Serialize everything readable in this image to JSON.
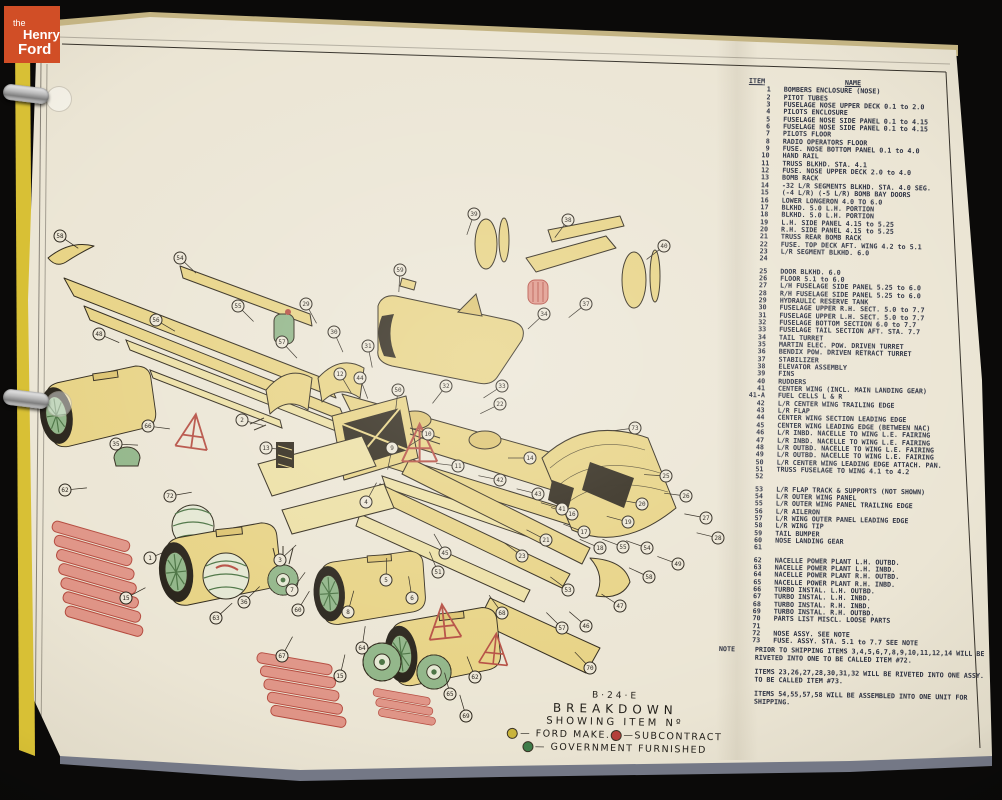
{
  "colors": {
    "page": "#ebe5d4",
    "part_yellow": "#e7d282",
    "part_shade": "#dcc26c",
    "outline": "#2b2416",
    "green": "#8fb486",
    "green_dark": "#47703f",
    "red": "#b44a3e",
    "red_light": "#df9486",
    "ink": "#2c3142",
    "logo_orange": "#d14e26",
    "binder_yellow": "#d8c035"
  },
  "logo": {
    "line1": "the",
    "line2": "Henry",
    "line3": "Ford"
  },
  "parts_list": {
    "header_item": "ITEM",
    "header_name": "NAME",
    "items": [
      {
        "no": "1",
        "name": "BOMBERS ENCLOSURE (NOSE)"
      },
      {
        "no": "2",
        "name": "PITOT TUBES"
      },
      {
        "no": "3",
        "name": "FUSELAGE NOSE UPPER DECK 0.1 to 2.0"
      },
      {
        "no": "4",
        "name": "PILOTS ENCLOSURE"
      },
      {
        "no": "5",
        "name": "FUSELAGE NOSE SIDE PANEL 0.1 to 4.15"
      },
      {
        "no": "6",
        "name": "FUSELAGE NOSE SIDE PANEL 0.1 to 4.15"
      },
      {
        "no": "7",
        "name": "PILOTS FLOOR"
      },
      {
        "no": "8",
        "name": "RADIO OPERATORS FLOOR"
      },
      {
        "no": "9",
        "name": "FUSE. NOSE BOTTOM PANEL 0.1 to 4.0"
      },
      {
        "no": "10",
        "name": "HAND RAIL"
      },
      {
        "no": "11",
        "name": "TRUSS BLKHD. STA. 4.1"
      },
      {
        "no": "12",
        "name": "FUSE. NOSE UPPER DECK 2.0 to 4.0"
      },
      {
        "no": "13",
        "name": "BOMB RACK"
      },
      {
        "no": "14",
        "name": "-32 L/R SEGMENTS BLKHD. STA. 4.0 SEG."
      },
      {
        "no": "15",
        "name": "(-4 L/R) (-5 L/R) BOMB BAY DOORS"
      },
      {
        "no": "16",
        "name": "LOWER LONGERON 4.0 TO 6.0"
      },
      {
        "no": "17",
        "name": "BLKHD. 5.0 L.H. PORTION"
      },
      {
        "no": "18",
        "name": "BLKHD. 5.0 L.H. PORTION"
      },
      {
        "no": "19",
        "name": "L.H. SIDE PANEL 4.15 to 5.25"
      },
      {
        "no": "20",
        "name": "R.H. SIDE PANEL 4.15 to 5.25"
      },
      {
        "no": "21",
        "name": "TRUSS REAR BOMB RACK"
      },
      {
        "no": "22",
        "name": "FUSE. TOP DECK AFT. WING 4.2 to 5.1"
      },
      {
        "no": "23",
        "name": "L/R SEGMENT BLKHD. 6.0"
      },
      {
        "no": "24",
        "name": "",
        "gap": true
      },
      {
        "no": "25",
        "name": "DOOR BLKHD. 6.0"
      },
      {
        "no": "26",
        "name": "FLOOR 5.1 to 6.0"
      },
      {
        "no": "27",
        "name": "L/H FUSELAGE SIDE PANEL 5.25 to 6.0"
      },
      {
        "no": "28",
        "name": "R/H FUSELAGE SIDE PANEL 5.25 to 6.0"
      },
      {
        "no": "29",
        "name": "HYDRAULIC RESERVE TANK"
      },
      {
        "no": "30",
        "name": "FUSELAGE UPPER R.H. SECT. 5.0 to 7.7"
      },
      {
        "no": "31",
        "name": "FUSELAGE UPPER L.H. SECT. 5.0 to 7.7"
      },
      {
        "no": "32",
        "name": "FUSELAGE BOTTOM SECTION 6.0 to 7.7"
      },
      {
        "no": "33",
        "name": "FUSELAGE TAIL SECTION AFT. STA. 7.7"
      },
      {
        "no": "34",
        "name": "TAIL TURRET"
      },
      {
        "no": "35",
        "name": "MARTIN ELEC. POW. DRIVEN TURRET"
      },
      {
        "no": "36",
        "name": "BENDIX POW. DRIVEN RETRACT TURRET"
      },
      {
        "no": "37",
        "name": "STABILIZER"
      },
      {
        "no": "38",
        "name": "ELEVATOR ASSEMBLY"
      },
      {
        "no": "39",
        "name": "FINS"
      },
      {
        "no": "40",
        "name": "RUDDERS"
      },
      {
        "no": "41",
        "name": "CENTER WING (INCL. MAIN LANDING GEAR)"
      },
      {
        "no": "41-A",
        "name": "FUEL CELLS L & R"
      },
      {
        "no": "42",
        "name": "L/R CENTER WING TRAILING EDGE"
      },
      {
        "no": "43",
        "name": "L/R FLAP"
      },
      {
        "no": "44",
        "name": "CENTER WING SECTION LEADING EDGE"
      },
      {
        "no": "45",
        "name": "CENTER WING LEADING EDGE (BETWEEN NAC)"
      },
      {
        "no": "46",
        "name": "L/R INBD. NACELLE TO WING L.E. FAIRING"
      },
      {
        "no": "47",
        "name": "L/R INBD. NACELLE TO WING L.E. FAIRING"
      },
      {
        "no": "48",
        "name": "L/R OUTBD. NACELLE TO WING L.E. FAIRING"
      },
      {
        "no": "49",
        "name": "L/R OUTBD. NACELLE TO WING L.E. FAIRING"
      },
      {
        "no": "50",
        "name": "L/R CENTER WING LEADING EDGE ATTACH. PAN."
      },
      {
        "no": "51",
        "name": "TRUSS FUSELAGE TO WING 4.1 to 4.2"
      },
      {
        "no": "52",
        "name": "",
        "gap": true
      },
      {
        "no": "53",
        "name": "L/R FLAP TRACK & SUPPORTS (NOT SHOWN)"
      },
      {
        "no": "54",
        "name": "L/R OUTER WING PANEL"
      },
      {
        "no": "55",
        "name": "L/R OUTER WING PANEL TRAILING EDGE"
      },
      {
        "no": "56",
        "name": "L/R AILERON"
      },
      {
        "no": "57",
        "name": "L/R WING OUTER PANEL LEADING EDGE"
      },
      {
        "no": "58",
        "name": "L/R WING TIP"
      },
      {
        "no": "59",
        "name": "TAIL BUMPER"
      },
      {
        "no": "60",
        "name": "NOSE LANDING GEAR"
      },
      {
        "no": "61",
        "name": "",
        "gap": true
      },
      {
        "no": "62",
        "name": "NACELLE POWER PLANT L.H. OUTBD."
      },
      {
        "no": "63",
        "name": "NACELLE POWER PLANT L.H. INBD."
      },
      {
        "no": "64",
        "name": "NACELLE POWER PLANT R.H. OUTBD."
      },
      {
        "no": "65",
        "name": "NACELLE POWER PLANT R.H. INBD."
      },
      {
        "no": "66",
        "name": "TURBO INSTAL. L.H. OUTBD."
      },
      {
        "no": "67",
        "name": "TURBO INSTAL. L.H. INBD."
      },
      {
        "no": "68",
        "name": "TURBO INSTAL. R.H. INBD."
      },
      {
        "no": "69",
        "name": "TURBO INSTAL. R.H. OUTBD."
      },
      {
        "no": "70",
        "name": "PARTS LIST MISCL. LOOSE PARTS"
      },
      {
        "no": "71",
        "name": ""
      },
      {
        "no": "72",
        "name": "NOSE ASSY. SEE NOTE"
      },
      {
        "no": "73",
        "name": "FUSE. ASSY. STA. 5.1 to 7.7 SEE NOTE"
      }
    ]
  },
  "note": {
    "label": "NOTE",
    "paragraphs": [
      "PRIOR TO SHIPPING ITEMS 3,4,5,6,7,8,9,10,11,12,14 WILL BE RIVETED INTO ONE TO BE CALLED ITEM #72.",
      "ITEMS 23,26,27,28,30,31,32 WILL BE RIVETED INTO ONE ASSY. TO BE CALLED ITEM #73.",
      "ITEMS 54,55,57,58 WILL BE ASSEMBLED INTO ONE UNIT FOR SHIPPING."
    ]
  },
  "title_block": {
    "line1": "B·24·E",
    "line2": "BREAKDOWN",
    "line3": "SHOWING ITEM Nº",
    "legend": [
      {
        "label": "— FORD MAKE.",
        "color": "#c9b43c"
      },
      {
        "label": "—SUBCONTRACT",
        "color": "#b5403a"
      },
      {
        "label": "— GOVERNMENT FURNISHED",
        "color": "#3f7d4a"
      }
    ]
  },
  "diagram": {
    "callouts": [
      {
        "n": "58",
        "x": 30,
        "y": 108
      },
      {
        "n": "54",
        "x": 150,
        "y": 130
      },
      {
        "n": "55",
        "x": 208,
        "y": 178
      },
      {
        "n": "57",
        "x": 252,
        "y": 214
      },
      {
        "n": "56",
        "x": 126,
        "y": 192
      },
      {
        "n": "48",
        "x": 69,
        "y": 206
      },
      {
        "n": "44",
        "x": 330,
        "y": 250
      },
      {
        "n": "50",
        "x": 368,
        "y": 262
      },
      {
        "n": "29",
        "x": 276,
        "y": 176
      },
      {
        "n": "30",
        "x": 304,
        "y": 204
      },
      {
        "n": "31",
        "x": 338,
        "y": 218
      },
      {
        "n": "12",
        "x": 310,
        "y": 246
      },
      {
        "n": "22",
        "x": 470,
        "y": 276
      },
      {
        "n": "32",
        "x": 416,
        "y": 258
      },
      {
        "n": "33",
        "x": 472,
        "y": 258
      },
      {
        "n": "34",
        "x": 514,
        "y": 186
      },
      {
        "n": "37",
        "x": 556,
        "y": 176
      },
      {
        "n": "38",
        "x": 538,
        "y": 92
      },
      {
        "n": "39",
        "x": 444,
        "y": 86
      },
      {
        "n": "40",
        "x": 634,
        "y": 118
      },
      {
        "n": "59",
        "x": 370,
        "y": 142
      },
      {
        "n": "73",
        "x": 605,
        "y": 300
      },
      {
        "n": "25",
        "x": 636,
        "y": 348
      },
      {
        "n": "26",
        "x": 656,
        "y": 368
      },
      {
        "n": "27",
        "x": 676,
        "y": 390
      },
      {
        "n": "28",
        "x": 688,
        "y": 410
      },
      {
        "n": "16",
        "x": 542,
        "y": 386
      },
      {
        "n": "17",
        "x": 554,
        "y": 404
      },
      {
        "n": "18",
        "x": 570,
        "y": 420
      },
      {
        "n": "19",
        "x": 598,
        "y": 394
      },
      {
        "n": "20",
        "x": 612,
        "y": 376
      },
      {
        "n": "21",
        "x": 516,
        "y": 412
      },
      {
        "n": "23",
        "x": 492,
        "y": 428
      },
      {
        "n": "41",
        "x": 532,
        "y": 381
      },
      {
        "n": "42",
        "x": 470,
        "y": 352
      },
      {
        "n": "43",
        "x": 508,
        "y": 366
      },
      {
        "n": "45",
        "x": 415,
        "y": 425
      },
      {
        "n": "51",
        "x": 408,
        "y": 444
      },
      {
        "n": "53",
        "x": 538,
        "y": 462
      },
      {
        "n": "46",
        "x": 556,
        "y": 498
      },
      {
        "n": "47",
        "x": 590,
        "y": 478
      },
      {
        "n": "49",
        "x": 648,
        "y": 436
      },
      {
        "n": "54",
        "x": 617,
        "y": 420
      },
      {
        "n": "55",
        "x": 593,
        "y": 419
      },
      {
        "n": "58",
        "x": 619,
        "y": 449
      },
      {
        "n": "57",
        "x": 532,
        "y": 500
      },
      {
        "n": "35",
        "x": 86,
        "y": 316
      },
      {
        "n": "66",
        "x": 118,
        "y": 298
      },
      {
        "n": "62",
        "x": 35,
        "y": 362
      },
      {
        "n": "72",
        "x": 140,
        "y": 368
      },
      {
        "n": "1",
        "x": 120,
        "y": 430
      },
      {
        "n": "2",
        "x": 212,
        "y": 292
      },
      {
        "n": "13",
        "x": 236,
        "y": 320
      },
      {
        "n": "3",
        "x": 250,
        "y": 432
      },
      {
        "n": "4",
        "x": 336,
        "y": 374
      },
      {
        "n": "7",
        "x": 262,
        "y": 462
      },
      {
        "n": "8",
        "x": 318,
        "y": 484
      },
      {
        "n": "9",
        "x": 362,
        "y": 320
      },
      {
        "n": "10",
        "x": 398,
        "y": 306
      },
      {
        "n": "11",
        "x": 428,
        "y": 338
      },
      {
        "n": "14",
        "x": 500,
        "y": 330
      },
      {
        "n": "5",
        "x": 356,
        "y": 452
      },
      {
        "n": "6",
        "x": 382,
        "y": 470
      },
      {
        "n": "15",
        "x": 96,
        "y": 470
      },
      {
        "n": "36",
        "x": 214,
        "y": 474
      },
      {
        "n": "60",
        "x": 268,
        "y": 482
      },
      {
        "n": "63",
        "x": 186,
        "y": 490
      },
      {
        "n": "67",
        "x": 252,
        "y": 528
      },
      {
        "n": "64",
        "x": 332,
        "y": 520
      },
      {
        "n": "68",
        "x": 472,
        "y": 485
      },
      {
        "n": "65",
        "x": 420,
        "y": 566
      },
      {
        "n": "69",
        "x": 436,
        "y": 588
      },
      {
        "n": "62",
        "x": 445,
        "y": 549
      },
      {
        "n": "70",
        "x": 560,
        "y": 540
      },
      {
        "n": "15",
        "x": 310,
        "y": 548
      }
    ]
  }
}
